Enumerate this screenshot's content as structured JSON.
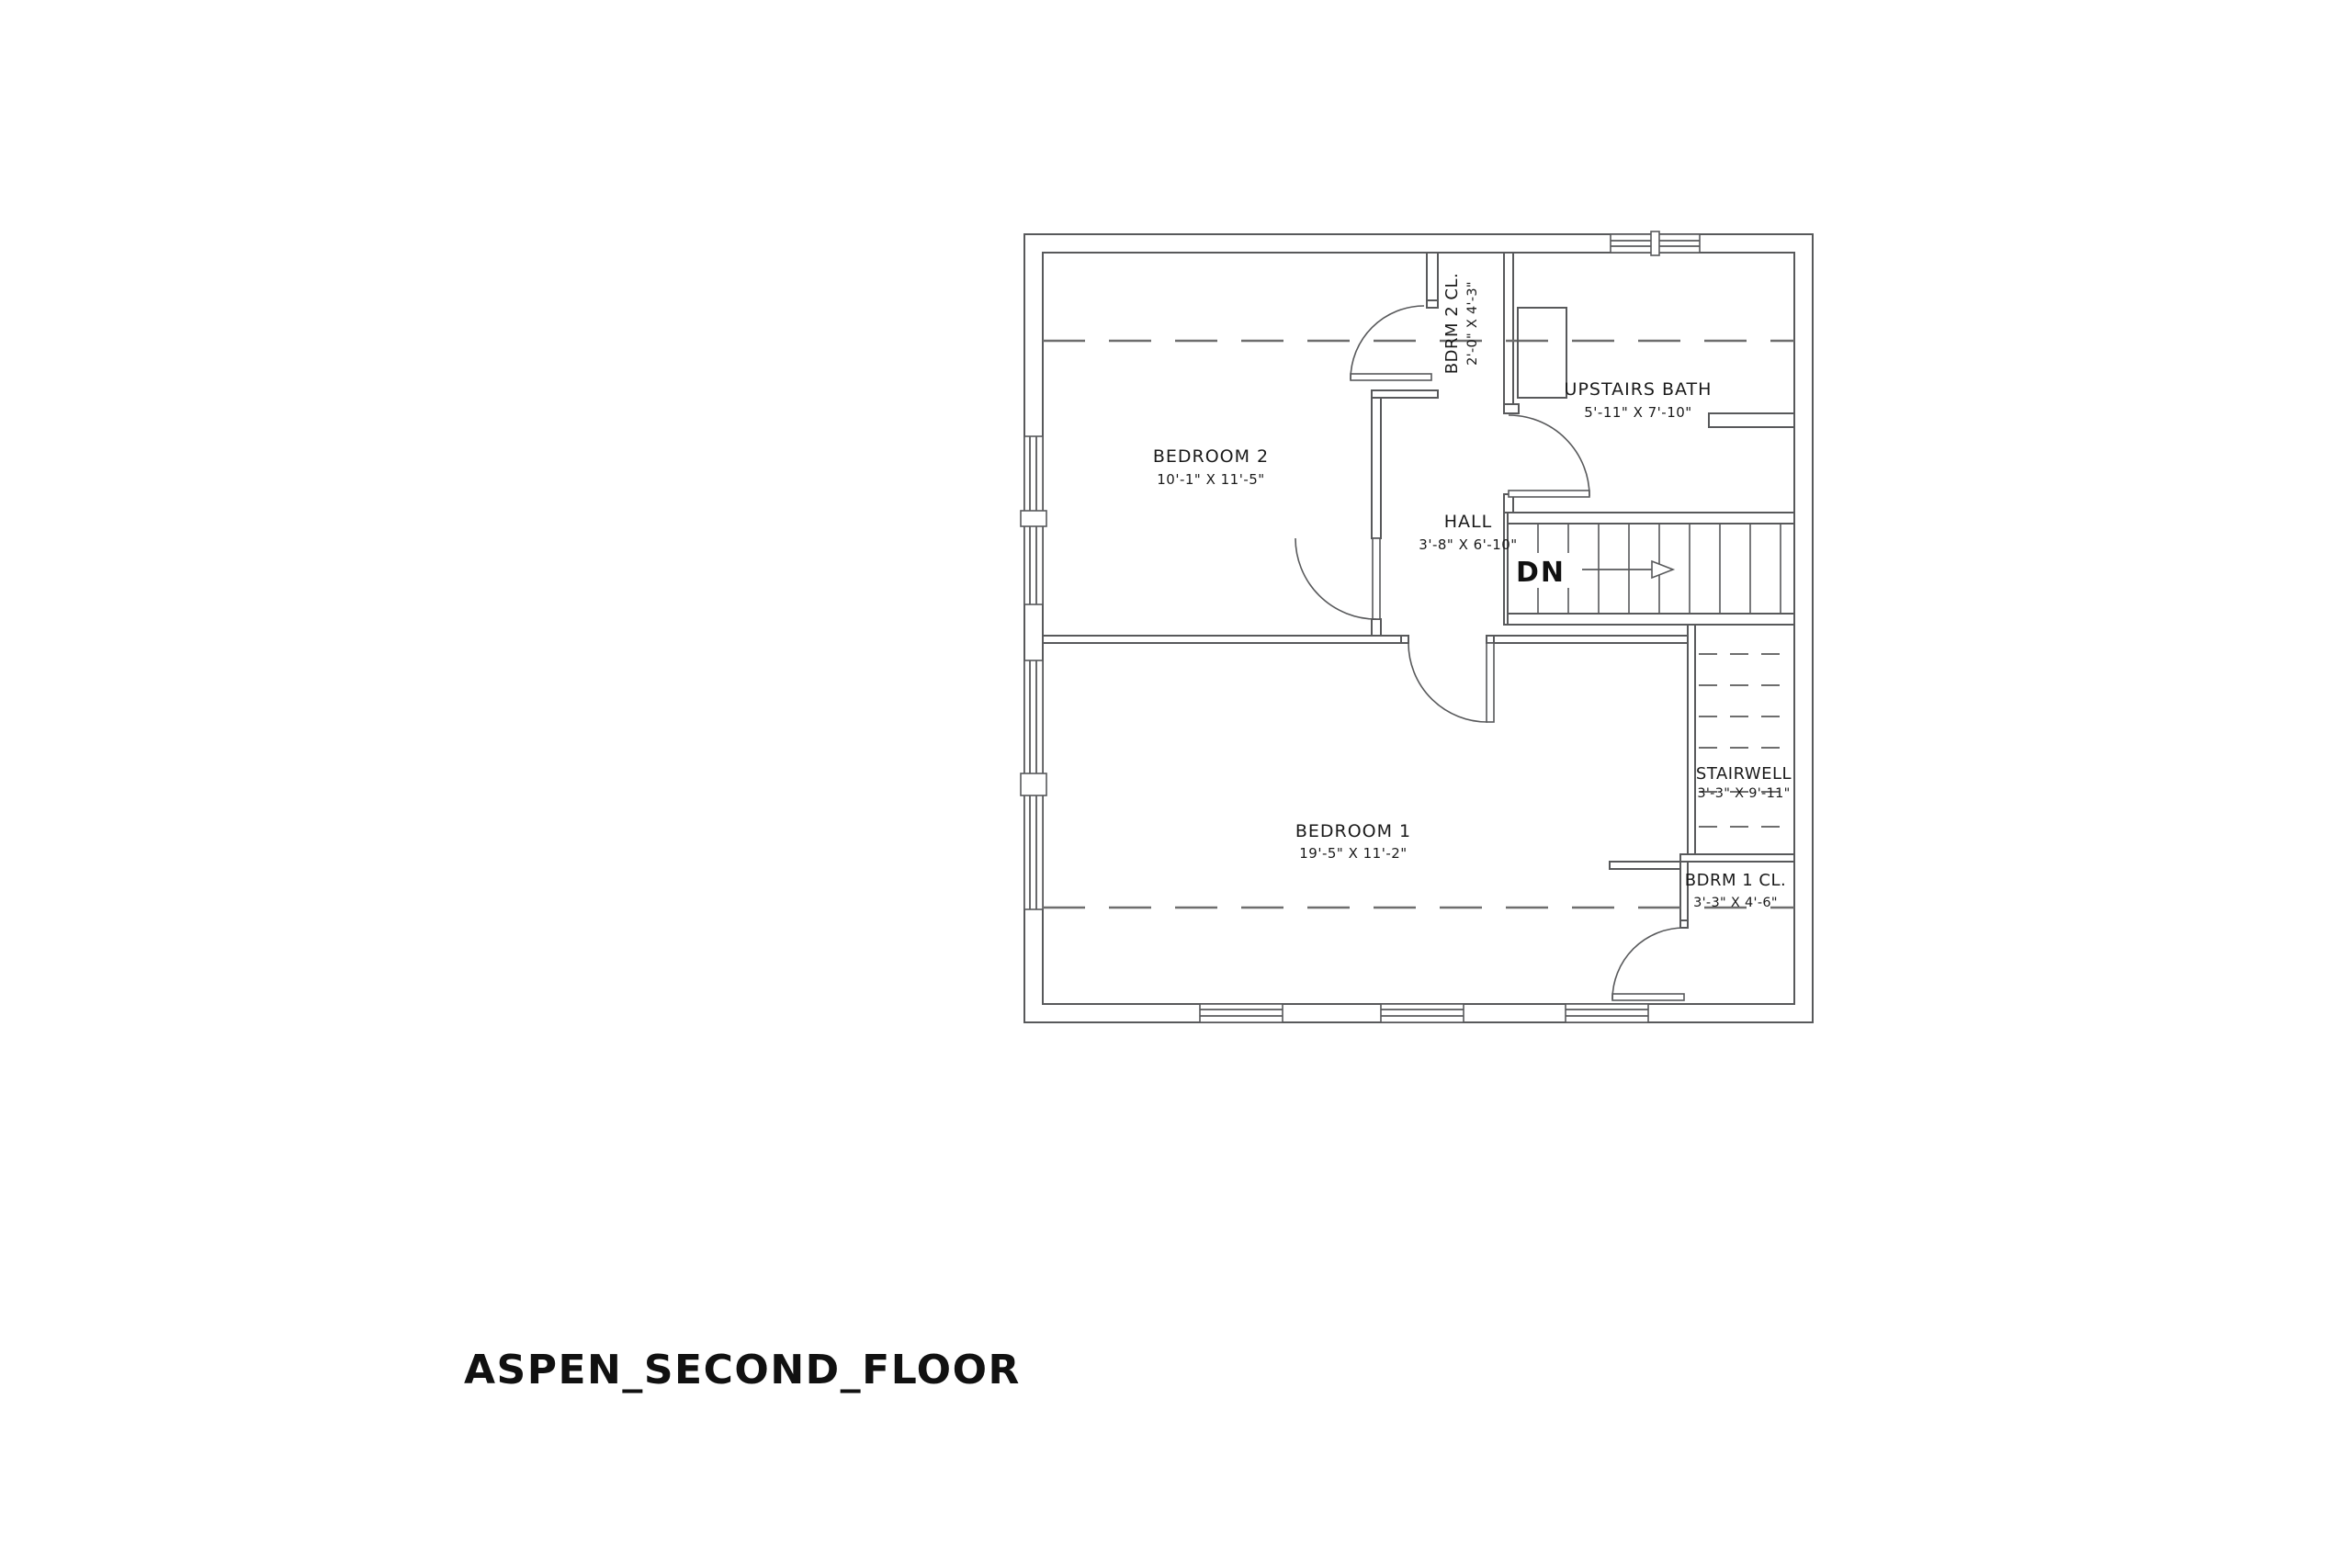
{
  "title": "ASPEN_SECOND_FLOOR",
  "rooms": [
    {
      "id": "bedroom2",
      "name": "BEDROOM 2",
      "dims": "10'-1\" X 11'-5\""
    },
    {
      "id": "bdrm2_closet",
      "name": "BDRM 2 CL.",
      "dims": "2'-0\" X 4'-3\""
    },
    {
      "id": "upstairs_bath",
      "name": "UPSTAIRS BATH",
      "dims": "5'-11\" X 7'-10\""
    },
    {
      "id": "hall",
      "name": "HALL",
      "dims": "3'-8\" X 6'-10\""
    },
    {
      "id": "bedroom1",
      "name": "BEDROOM 1",
      "dims": "19'-5\" X 11'-2\""
    },
    {
      "id": "bdrm1_closet",
      "name": "BDRM 1 CL.",
      "dims": "3'-3\" X 4'-6\""
    },
    {
      "id": "stairwell",
      "name": "STAIRWELL",
      "dims": "3'-3\" X 9'-11\""
    }
  ],
  "stairs": {
    "direction_label": "DN"
  },
  "colors": {
    "line": "#58595b",
    "dash": "#6e6e6e",
    "text": "#1a1a1a",
    "background": "#ffffff"
  }
}
